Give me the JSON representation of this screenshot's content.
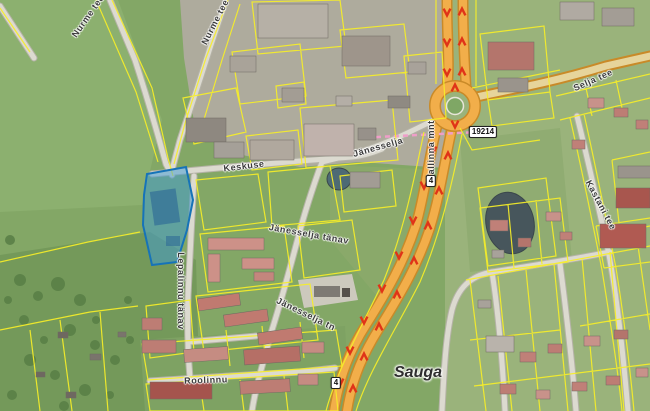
{
  "map": {
    "description": "Aerial orthophoto web map of Sauga (Estonia) with yellow cadastral parcel boundaries, an orange trunk road no. 4 with a roundabout, and one parcel highlighted in blue",
    "place_labels": [
      {
        "text": "Sauga",
        "x": 418,
        "y": 373,
        "rot": 0
      }
    ],
    "street_labels": [
      {
        "text": "Nurme tee",
        "x": 88,
        "y": 16,
        "rot": -55
      },
      {
        "text": "Nurme tee",
        "x": 215,
        "y": 22,
        "rot": -63
      },
      {
        "text": "Keskuse",
        "x": 244,
        "y": 166,
        "rot": -7
      },
      {
        "text": "Jänesselja",
        "x": 378,
        "y": 147,
        "rot": -16
      },
      {
        "text": "Tallinna mnt",
        "x": 431,
        "y": 150,
        "rot": -90
      },
      {
        "text": "Jänesselja tänav",
        "x": 309,
        "y": 234,
        "rot": 10
      },
      {
        "text": "Jänesselja tn",
        "x": 306,
        "y": 314,
        "rot": 26
      },
      {
        "text": "Lepalinnu tänav",
        "x": 181,
        "y": 291,
        "rot": 90
      },
      {
        "text": "Roolinnu",
        "x": 206,
        "y": 380,
        "rot": -2
      },
      {
        "text": "Selja tee",
        "x": 593,
        "y": 80,
        "rot": -24
      },
      {
        "text": "Kastani tee",
        "x": 601,
        "y": 205,
        "rot": 62
      }
    ],
    "road_badges": [
      {
        "text": "19214",
        "x": 483,
        "y": 132
      },
      {
        "text": "4",
        "x": 431,
        "y": 181
      },
      {
        "text": "4",
        "x": 336,
        "y": 383
      }
    ],
    "highlighted_parcel": {
      "fill": "#3d9bd6",
      "fill_opacity": 0.5,
      "stroke": "#1673b8"
    },
    "colors": {
      "field_green": "#83a766",
      "parcel_line": "#f6ee28",
      "main_road": "#f2ae4a",
      "main_road_edge": "#c98a28",
      "minor_road": "#dcdad0",
      "minor_road_edge": "#b4b2a6",
      "direction_arrow": "#e03318",
      "planning_line_pink": "#ef9ec9",
      "water": "#47565c",
      "label_text": "#3b3b3b"
    }
  }
}
